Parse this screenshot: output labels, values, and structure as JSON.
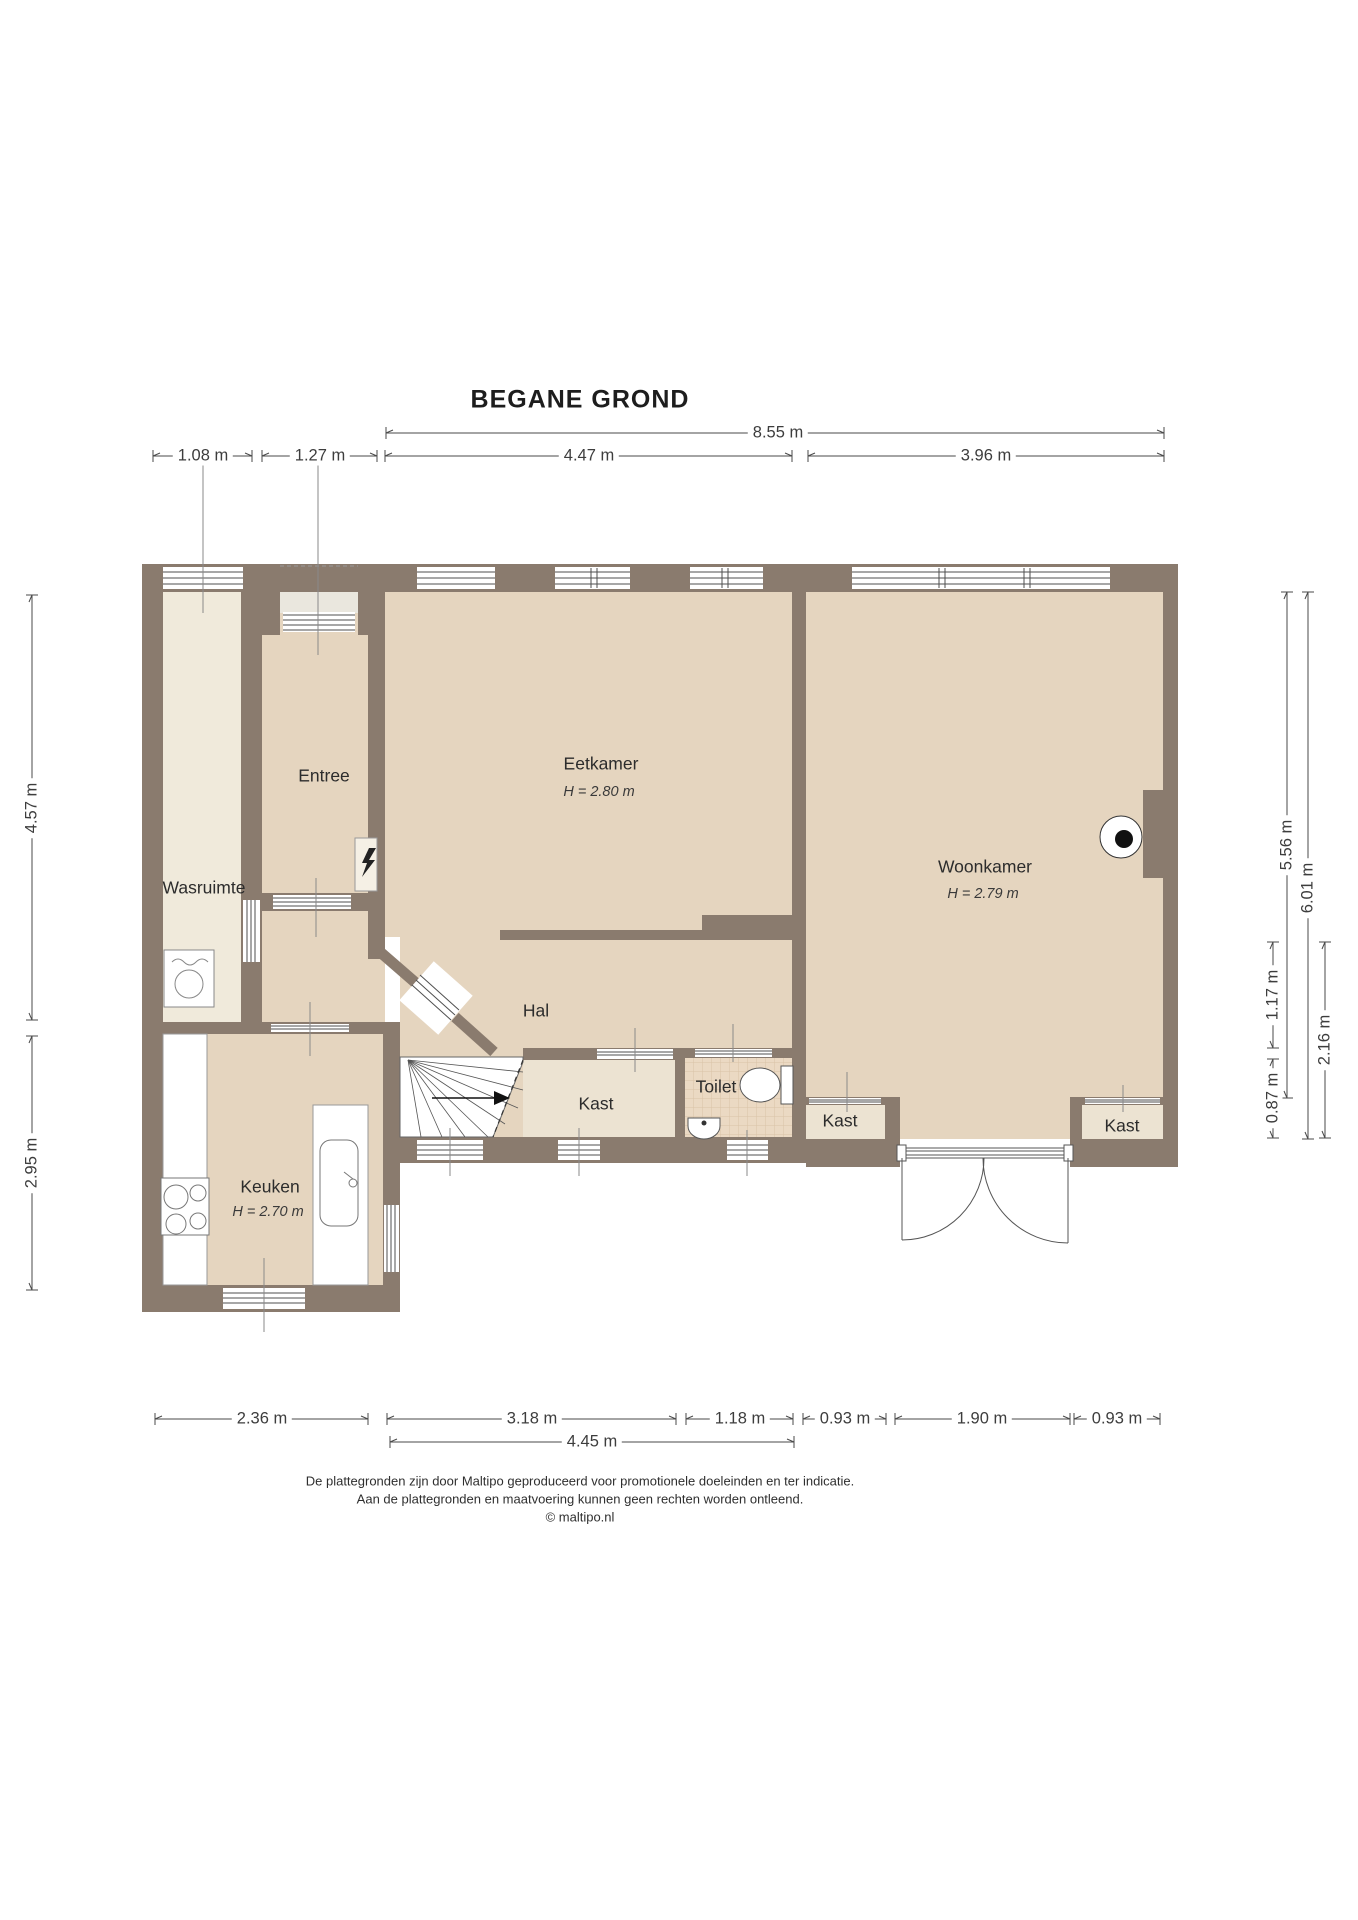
{
  "title": "BEGANE GROND",
  "footer": {
    "line1": "De plattegronden zijn door Maltipo geproduceerd voor promotionele doeleinden en ter indicatie.",
    "line2": "Aan de plattegronden en maatvoering kunnen geen rechten worden ontleend.",
    "line3": "© maltipo.nl"
  },
  "colors": {
    "wall": "#8A7B6E",
    "floor_main": "#E5D5BF",
    "floor_light": "#F0EADB",
    "floor_kast": "#ECE3D2",
    "floor_porch": "#EAE7DE",
    "tile": "#EBD9C3",
    "tile_line": "#D9C2A7",
    "dim_line": "#4a4a4a",
    "frame_line": "#4f4f4f"
  },
  "rooms": [
    {
      "id": "wasruimte",
      "label": "Wasruimte",
      "x": 204,
      "y": 888
    },
    {
      "id": "entree",
      "label": "Entree",
      "x": 324,
      "y": 776
    },
    {
      "id": "eetkamer",
      "label": "Eetkamer",
      "x": 601,
      "y": 764,
      "sub": "H = 2.80 m",
      "subx": 599,
      "suby": 792
    },
    {
      "id": "woonkamer",
      "label": "Woonkamer",
      "x": 985,
      "y": 867,
      "sub": "H = 2.79 m",
      "subx": 983,
      "suby": 894
    },
    {
      "id": "hal",
      "label": "Hal",
      "x": 536,
      "y": 1011
    },
    {
      "id": "keuken",
      "label": "Keuken",
      "x": 270,
      "y": 1187,
      "sub": "H = 2.70 m",
      "subx": 268,
      "suby": 1212
    },
    {
      "id": "kast-stairs",
      "label": "Kast",
      "x": 596,
      "y": 1104
    },
    {
      "id": "toilet",
      "label": "Toilet",
      "x": 716,
      "y": 1087
    },
    {
      "id": "kast-mid",
      "label": "Kast",
      "x": 840,
      "y": 1121
    },
    {
      "id": "kast-right",
      "label": "Kast",
      "x": 1122,
      "y": 1126
    }
  ],
  "dimensions": [
    {
      "label": "8.55 m",
      "x1": 386,
      "y1": 433,
      "x2": 1164,
      "y2": 433,
      "lx": 778,
      "ly": 433,
      "rot": false
    },
    {
      "label": "1.08 m",
      "x1": 153,
      "y1": 456,
      "x2": 252,
      "y2": 456,
      "lx": 203,
      "ly": 456,
      "rot": false
    },
    {
      "label": "1.27 m",
      "x1": 262,
      "y1": 456,
      "x2": 377,
      "y2": 456,
      "lx": 320,
      "ly": 456,
      "rot": false
    },
    {
      "label": "4.47 m",
      "x1": 385,
      "y1": 456,
      "x2": 792,
      "y2": 456,
      "lx": 589,
      "ly": 456,
      "rot": false
    },
    {
      "label": "3.96 m",
      "x1": 808,
      "y1": 456,
      "x2": 1164,
      "y2": 456,
      "lx": 986,
      "ly": 456,
      "rot": false
    },
    {
      "label": "4.57 m",
      "x1": 32,
      "y1": 595,
      "x2": 32,
      "y2": 1020,
      "lx": 32,
      "ly": 808,
      "rot": true
    },
    {
      "label": "2.95 m",
      "x1": 32,
      "y1": 1036,
      "x2": 32,
      "y2": 1290,
      "lx": 32,
      "ly": 1163,
      "rot": true
    },
    {
      "label": "5.56 m",
      "x1": 1287,
      "y1": 592,
      "x2": 1287,
      "y2": 1098,
      "lx": 1287,
      "ly": 845,
      "rot": true
    },
    {
      "label": "6.01 m",
      "x1": 1308,
      "y1": 592,
      "x2": 1308,
      "y2": 1139,
      "lx": 1308,
      "ly": 888,
      "rot": true
    },
    {
      "label": "1.17 m",
      "x1": 1273,
      "y1": 942,
      "x2": 1273,
      "y2": 1048,
      "lx": 1273,
      "ly": 995,
      "rot": true
    },
    {
      "label": "0.87 m",
      "x1": 1273,
      "y1": 1059,
      "x2": 1273,
      "y2": 1138,
      "lx": 1273,
      "ly": 1098,
      "rot": true
    },
    {
      "label": "2.16 m",
      "x1": 1325,
      "y1": 942,
      "x2": 1325,
      "y2": 1138,
      "lx": 1325,
      "ly": 1040,
      "rot": true
    },
    {
      "label": "2.36 m",
      "x1": 155,
      "y1": 1419,
      "x2": 368,
      "y2": 1419,
      "lx": 262,
      "ly": 1419,
      "rot": false
    },
    {
      "label": "3.18 m",
      "x1": 387,
      "y1": 1419,
      "x2": 676,
      "y2": 1419,
      "lx": 532,
      "ly": 1419,
      "rot": false
    },
    {
      "label": "1.18 m",
      "x1": 686,
      "y1": 1419,
      "x2": 793,
      "y2": 1419,
      "lx": 740,
      "ly": 1419,
      "rot": false
    },
    {
      "label": "0.93 m",
      "x1": 803,
      "y1": 1419,
      "x2": 886,
      "y2": 1419,
      "lx": 845,
      "ly": 1419,
      "rot": false
    },
    {
      "label": "1.90 m",
      "x1": 895,
      "y1": 1419,
      "x2": 1070,
      "y2": 1419,
      "lx": 982,
      "ly": 1419,
      "rot": false
    },
    {
      "label": "0.93 m",
      "x1": 1074,
      "y1": 1419,
      "x2": 1160,
      "y2": 1419,
      "lx": 1117,
      "ly": 1419,
      "rot": false
    },
    {
      "label": "4.45 m",
      "x1": 390,
      "y1": 1442,
      "x2": 794,
      "y2": 1442,
      "lx": 592,
      "ly": 1442,
      "rot": false
    }
  ],
  "fixtures": [
    "washing-machine",
    "stove",
    "kitchen-sink",
    "toilet-bowl",
    "toilet-sink",
    "stairs",
    "french-doors",
    "wall-light",
    "electric-meter"
  ]
}
